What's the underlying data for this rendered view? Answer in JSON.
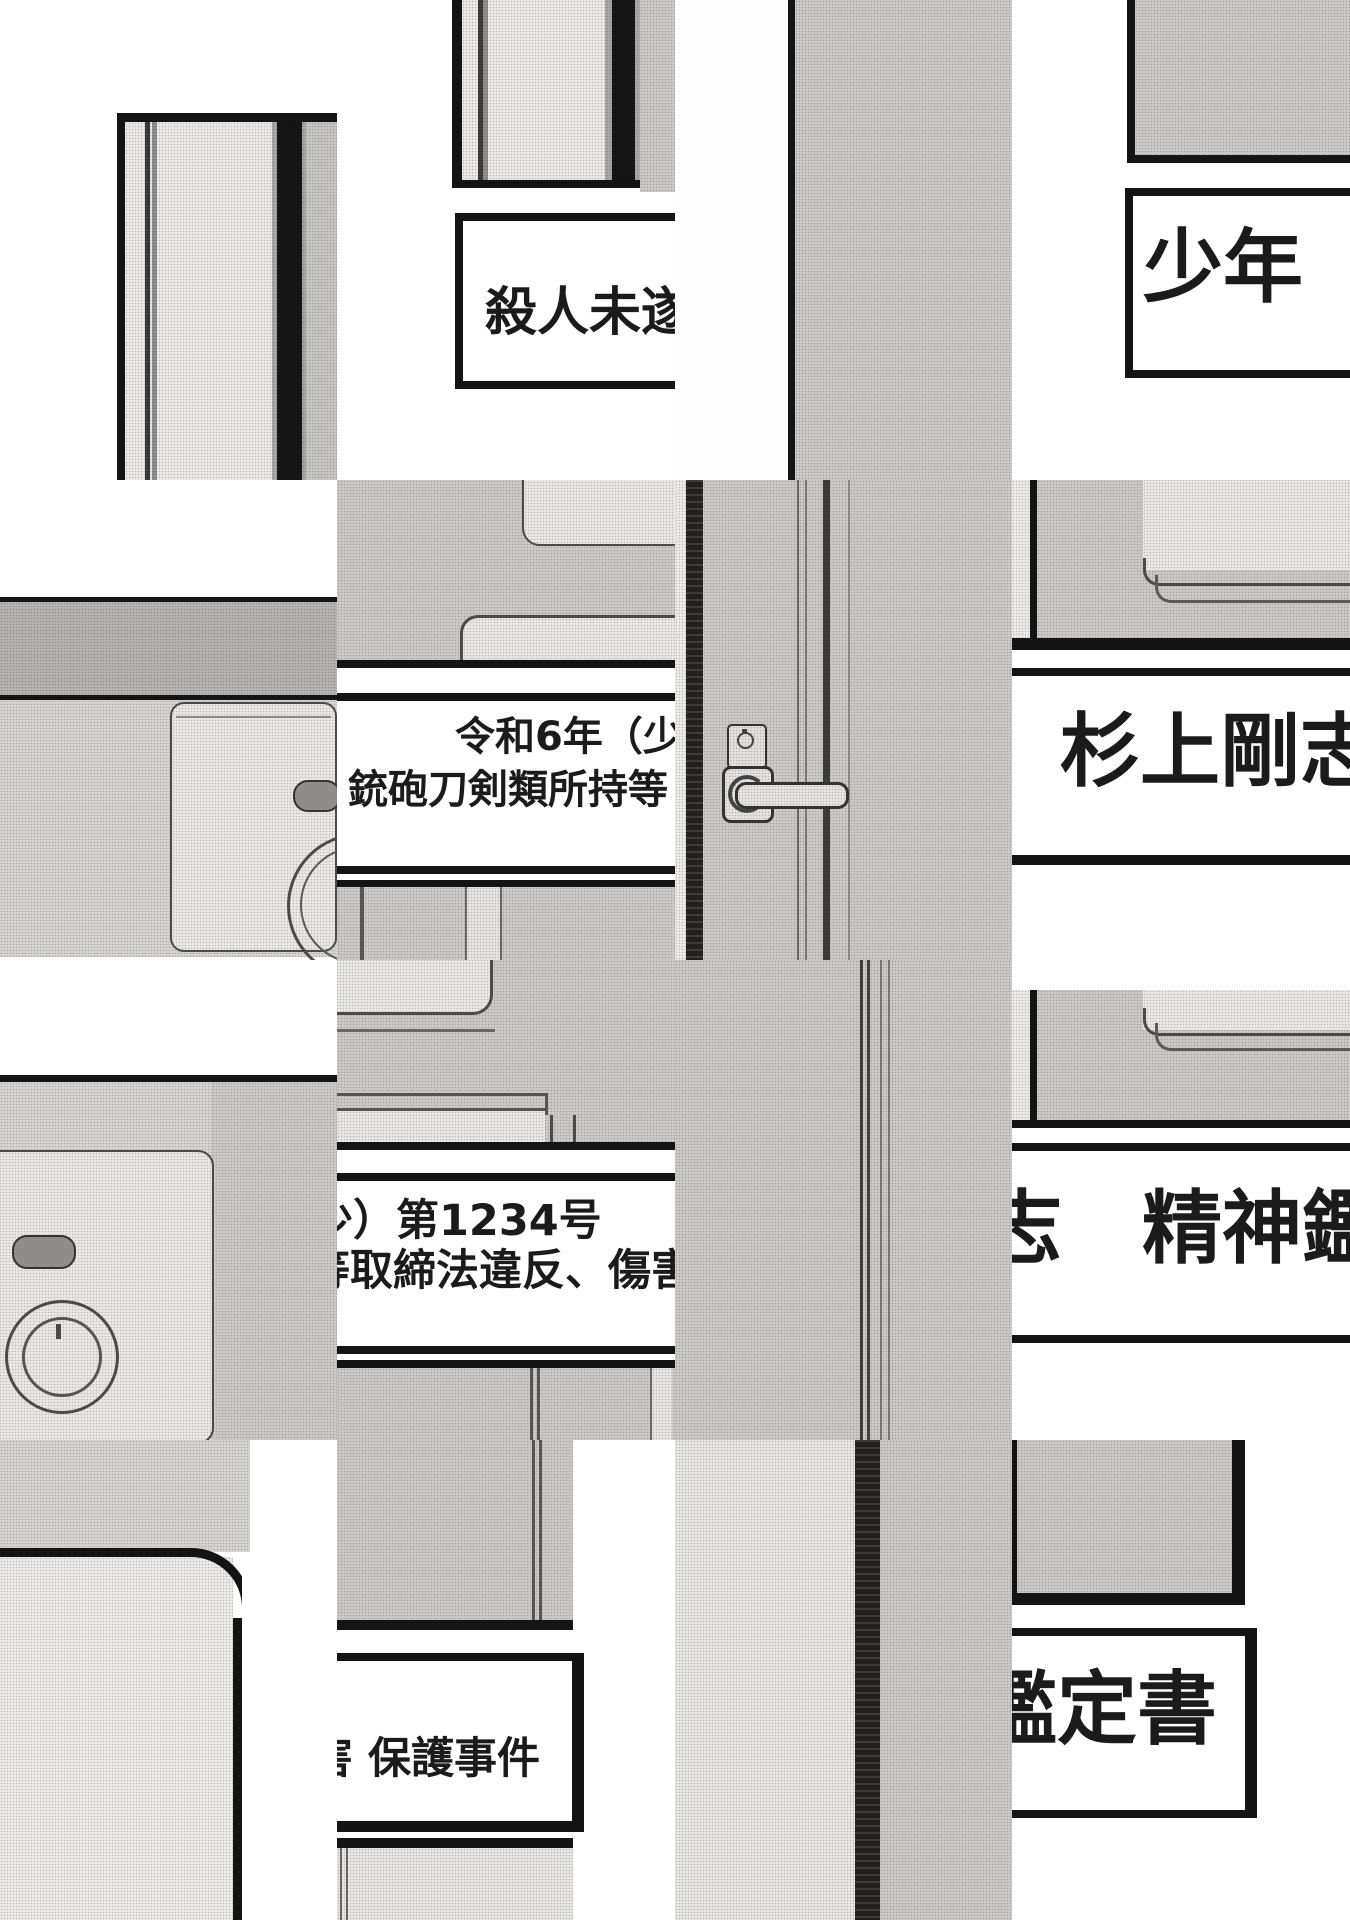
{
  "page": {
    "paper": "#ffffff",
    "ink": "#141414",
    "tone_light": "#ecebe9",
    "tone_mid": "#cbcac8",
    "tone_dark": "#b5b4b2"
  },
  "captions": {
    "attempted_murder": "殺人未遂、",
    "juvenile": "少年",
    "case_year_line1": "令和6年（少",
    "case_year_line2": "銃砲刀剣類所持等",
    "subject_name": "杉上剛志",
    "case_number_line1": "少）第1234号",
    "case_number_line2": "等取締法違反、傷害",
    "psych_fragment": "志　精神鑑",
    "protection_case": "害 保護事件",
    "report_title": "鑑定書"
  }
}
